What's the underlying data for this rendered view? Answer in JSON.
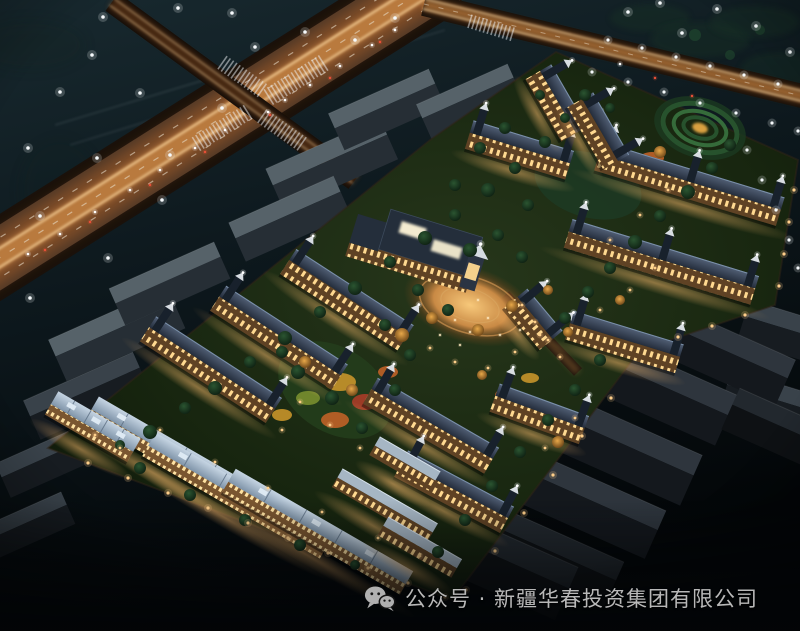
{
  "caption": {
    "text": "公众号 · 新疆华春投资集团有限公司",
    "icon": "wechat-icon"
  },
  "palette": {
    "sky_top": "#18292f",
    "sky_mid": "#0d181d",
    "sky_bottom": "#030608",
    "road_base": "#513826",
    "road_glow": "#c06a2c",
    "road_hot": "#f5a855",
    "streak": "#ffd9a0",
    "lane_dash": "#e8dcc8",
    "roof_slate_hi": "#526076",
    "roof_slate_lo": "#242d3c",
    "ridge": "#8097b1",
    "facade_dark": "#5f4224",
    "window_warm": "#ffd990",
    "roof_blue_hi": "#c6d5e3",
    "roof_blue_lo": "#7e93a8",
    "flat_roof": "#a6b6c4",
    "lawn_hi": "#27371b",
    "lawn_lo": "#0d1609",
    "tree_dark": "#152e1b",
    "tree_mid": "#2b5531",
    "tree_lit": "#c58a35",
    "wall_light": "#ffcf8a",
    "white_light": "#f6fafc",
    "red_tail": "#e85038",
    "plaza_core": "#f7c87a",
    "plaza_mid": "#9a6030",
    "caption_text": "#b8b8b8",
    "wechat_icon": "#b0b0b0"
  },
  "scene": {
    "sky_lights": [
      [
        103,
        17
      ],
      [
        178,
        8
      ],
      [
        232,
        13
      ],
      [
        305,
        32
      ],
      [
        355,
        40
      ],
      [
        395,
        18
      ],
      [
        92,
        55
      ],
      [
        255,
        47
      ],
      [
        60,
        92
      ],
      [
        140,
        93
      ],
      [
        222,
        108
      ],
      [
        28,
        148
      ],
      [
        97,
        158
      ],
      [
        170,
        155
      ],
      [
        162,
        200
      ],
      [
        40,
        216
      ],
      [
        108,
        258
      ],
      [
        30,
        298
      ],
      [
        628,
        12
      ],
      [
        682,
        33
      ],
      [
        717,
        9
      ],
      [
        756,
        26
      ],
      [
        790,
        52
      ],
      [
        660,
        3
      ]
    ],
    "road_c_lights": [
      [
        608,
        40
      ],
      [
        642,
        48
      ],
      [
        676,
        57
      ],
      [
        710,
        66
      ],
      [
        744,
        75
      ],
      [
        778,
        84
      ],
      [
        592,
        72
      ],
      [
        628,
        82
      ],
      [
        664,
        92
      ],
      [
        700,
        103
      ],
      [
        736,
        113
      ],
      [
        772,
        123
      ],
      [
        798,
        131
      ]
    ],
    "right_lights": [
      [
        747,
        150
      ],
      [
        762,
        180
      ],
      [
        776,
        210
      ],
      [
        789,
        240
      ],
      [
        798,
        268
      ]
    ],
    "wall_lights": [
      [
        88,
        463
      ],
      [
        128,
        478
      ],
      [
        168,
        493
      ],
      [
        208,
        508
      ],
      [
        248,
        523
      ],
      [
        288,
        538
      ],
      [
        328,
        553
      ],
      [
        368,
        568
      ],
      [
        408,
        583
      ],
      [
        445,
        597
      ],
      [
        794,
        190
      ],
      [
        789,
        222
      ],
      [
        784,
        254
      ],
      [
        779,
        286
      ],
      [
        745,
        315
      ],
      [
        712,
        326
      ],
      [
        678,
        337
      ],
      [
        611,
        398
      ],
      [
        582,
        436
      ],
      [
        553,
        475
      ],
      [
        524,
        513
      ],
      [
        495,
        551
      ],
      [
        466,
        590
      ]
    ],
    "path_lamps": [
      [
        160,
        430
      ],
      [
        215,
        462
      ],
      [
        268,
        488
      ],
      [
        322,
        512
      ],
      [
        378,
        538
      ],
      [
        420,
        556
      ],
      [
        300,
        402
      ],
      [
        330,
        425
      ],
      [
        360,
        448
      ],
      [
        282,
        430
      ],
      [
        430,
        348
      ],
      [
        455,
        362
      ],
      [
        488,
        368
      ],
      [
        515,
        352
      ],
      [
        540,
        335
      ],
      [
        522,
        305
      ],
      [
        535,
        322
      ],
      [
        548,
        340
      ],
      [
        560,
        357
      ],
      [
        600,
        310
      ],
      [
        630,
        290
      ],
      [
        655,
        268
      ],
      [
        120,
        448
      ],
      [
        95,
        435
      ],
      [
        575,
        418
      ],
      [
        545,
        448
      ],
      [
        610,
        240
      ],
      [
        640,
        215
      ],
      [
        668,
        190
      ]
    ],
    "car_white": [
      [
        395,
        30
      ],
      [
        372,
        45
      ],
      [
        340,
        66
      ],
      [
        310,
        85
      ],
      [
        285,
        100
      ],
      [
        225,
        130
      ],
      [
        195,
        148
      ],
      [
        160,
        170
      ],
      [
        130,
        190
      ],
      [
        95,
        212
      ],
      [
        60,
        234
      ],
      [
        28,
        254
      ],
      [
        620,
        64
      ],
      [
        268,
        112
      ]
    ],
    "car_red": [
      [
        380,
        42
      ],
      [
        330,
        78
      ],
      [
        270,
        115
      ],
      [
        205,
        152
      ],
      [
        150,
        185
      ],
      [
        90,
        222
      ],
      [
        45,
        250
      ],
      [
        655,
        78
      ],
      [
        692,
        96
      ]
    ],
    "people": [
      [
        455,
        320
      ],
      [
        470,
        332
      ],
      [
        488,
        318
      ],
      [
        500,
        335
      ],
      [
        460,
        345
      ],
      [
        520,
        330
      ],
      [
        478,
        300
      ],
      [
        440,
        335
      ]
    ],
    "buildings": [
      {
        "cx": 690,
        "cy": 182,
        "len": 190,
        "rot": 17,
        "style": "A"
      },
      {
        "cx": 662,
        "cy": 260,
        "len": 195,
        "rot": 17,
        "style": "A"
      },
      {
        "cx": 625,
        "cy": 340,
        "len": 115,
        "rot": 17,
        "style": "A"
      },
      {
        "cx": 540,
        "cy": 412,
        "len": 95,
        "rot": 20,
        "style": "A"
      },
      {
        "cx": 520,
        "cy": 148,
        "len": 105,
        "rot": 17,
        "style": "A"
      },
      {
        "cx": 558,
        "cy": 102,
        "len": 72,
        "rot": 60,
        "style": "A"
      },
      {
        "cx": 600,
        "cy": 130,
        "len": 72,
        "rot": 60,
        "style": "A"
      },
      {
        "cx": 212,
        "cy": 368,
        "len": 150,
        "rot": 33,
        "style": "A"
      },
      {
        "cx": 280,
        "cy": 336,
        "len": 145,
        "rot": 33,
        "style": "A"
      },
      {
        "cx": 348,
        "cy": 298,
        "len": 140,
        "rot": 33,
        "style": "A"
      },
      {
        "cx": 432,
        "cy": 424,
        "len": 140,
        "rot": 30,
        "style": "A"
      },
      {
        "cx": 455,
        "cy": 490,
        "len": 120,
        "rot": 28,
        "style": "A"
      },
      {
        "cx": 535,
        "cy": 318,
        "len": 55,
        "rot": 50,
        "style": "A"
      },
      {
        "cx": 165,
        "cy": 452,
        "len": 170,
        "rot": 30,
        "style": "B"
      },
      {
        "cx": 237,
        "cy": 497,
        "len": 205,
        "rot": 30,
        "style": "B"
      },
      {
        "cx": 317,
        "cy": 533,
        "len": 205,
        "rot": 30,
        "style": "B"
      },
      {
        "cx": 92,
        "cy": 428,
        "len": 95,
        "rot": 30,
        "style": "B"
      },
      {
        "cx": 385,
        "cy": 505,
        "len": 110,
        "rot": 30,
        "style": "C"
      },
      {
        "cx": 420,
        "cy": 547,
        "len": 85,
        "rot": 30,
        "style": "C"
      },
      {
        "cx": 405,
        "cy": 463,
        "len": 70,
        "rot": 30,
        "style": "C"
      }
    ],
    "gray_blocks": [
      [
        330,
        160,
        125,
        36,
        -24,
        "a"
      ],
      [
        288,
        215,
        115,
        34,
        -24,
        "a"
      ],
      [
        385,
        106,
        110,
        32,
        -24,
        "a"
      ],
      [
        468,
        98,
        100,
        30,
        -24,
        "a"
      ],
      [
        115,
        330,
        130,
        36,
        -24,
        "a"
      ],
      [
        85,
        392,
        120,
        34,
        -24,
        "b"
      ],
      [
        168,
        280,
        115,
        32,
        -24,
        "a"
      ],
      [
        45,
        458,
        95,
        30,
        -24,
        "b"
      ],
      [
        28,
        522,
        85,
        28,
        -24,
        "b"
      ],
      [
        790,
        330,
        95,
        34,
        17,
        "b"
      ],
      [
        770,
        398,
        90,
        32,
        17,
        "b"
      ],
      [
        660,
        385,
        150,
        44,
        24,
        "p"
      ],
      [
        625,
        445,
        150,
        44,
        24,
        "p"
      ],
      [
        590,
        500,
        148,
        42,
        24,
        "p"
      ],
      [
        552,
        552,
        140,
        40,
        24,
        "q"
      ],
      [
        735,
        355,
        115,
        40,
        24,
        "p"
      ],
      [
        778,
        425,
        100,
        36,
        24,
        "q"
      ],
      [
        505,
        560,
        140,
        46,
        24,
        "q"
      ]
    ],
    "trees": [
      [
        150,
        432,
        7
      ],
      [
        185,
        408,
        6
      ],
      [
        215,
        388,
        7
      ],
      [
        250,
        362,
        6
      ],
      [
        285,
        338,
        7
      ],
      [
        320,
        312,
        6
      ],
      [
        355,
        288,
        7
      ],
      [
        390,
        262,
        6
      ],
      [
        425,
        238,
        7
      ],
      [
        455,
        215,
        6
      ],
      [
        488,
        190,
        7
      ],
      [
        515,
        168,
        6
      ],
      [
        545,
        142,
        6
      ],
      [
        565,
        118,
        5
      ],
      [
        585,
        95,
        6
      ],
      [
        610,
        108,
        5
      ],
      [
        540,
        95,
        5
      ],
      [
        505,
        128,
        6
      ],
      [
        480,
        148,
        6
      ],
      [
        730,
        145,
        6
      ],
      [
        712,
        168,
        6
      ],
      [
        688,
        192,
        7
      ],
      [
        660,
        216,
        6
      ],
      [
        635,
        242,
        7
      ],
      [
        610,
        268,
        6
      ],
      [
        588,
        292,
        6
      ],
      [
        565,
        318,
        6
      ],
      [
        600,
        360,
        6
      ],
      [
        575,
        390,
        6
      ],
      [
        548,
        420,
        6
      ],
      [
        520,
        452,
        6
      ],
      [
        492,
        486,
        6
      ],
      [
        465,
        520,
        6
      ],
      [
        438,
        552,
        6
      ],
      [
        140,
        468,
        6
      ],
      [
        190,
        495,
        6
      ],
      [
        245,
        520,
        6
      ],
      [
        300,
        545,
        6
      ],
      [
        355,
        565,
        5
      ],
      [
        120,
        445,
        5
      ],
      [
        470,
        250,
        7
      ],
      [
        498,
        235,
        6
      ],
      [
        522,
        257,
        6
      ],
      [
        455,
        185,
        6
      ],
      [
        528,
        205,
        6
      ],
      [
        410,
        355,
        6
      ],
      [
        385,
        325,
        6
      ],
      [
        298,
        372,
        7
      ],
      [
        332,
        398,
        7
      ],
      [
        362,
        428,
        6
      ],
      [
        395,
        390,
        6
      ],
      [
        282,
        352,
        6
      ],
      [
        448,
        310,
        6
      ],
      [
        418,
        290,
        6
      ]
    ],
    "lit_trees": [
      [
        402,
        335,
        7
      ],
      [
        432,
        318,
        6
      ],
      [
        478,
        330,
        6
      ],
      [
        512,
        306,
        6
      ],
      [
        548,
        290,
        5
      ],
      [
        660,
        152,
        6
      ],
      [
        305,
        362,
        6
      ],
      [
        352,
        390,
        6
      ],
      [
        558,
        442,
        6
      ],
      [
        482,
        375,
        5
      ],
      [
        568,
        332,
        5
      ],
      [
        620,
        300,
        5
      ]
    ],
    "flower_colors": [
      "#c96428",
      "#d19a2c",
      "#b23c28",
      "#7e9430"
    ],
    "flower_patches": [
      [
        315,
        360,
        14,
        8,
        0
      ],
      [
        340,
        382,
        16,
        9,
        1
      ],
      [
        365,
        402,
        13,
        8,
        2
      ],
      [
        308,
        398,
        12,
        7,
        3
      ],
      [
        388,
        372,
        10,
        6,
        0
      ],
      [
        335,
        420,
        14,
        8,
        0
      ],
      [
        282,
        415,
        10,
        6,
        1
      ],
      [
        652,
        158,
        12,
        6,
        0
      ],
      [
        625,
        172,
        10,
        5,
        3
      ],
      [
        505,
        395,
        10,
        6,
        0
      ],
      [
        530,
        378,
        9,
        5,
        1
      ]
    ],
    "crosswalks": [
      [
        296,
        80,
        64,
        18,
        -32
      ],
      [
        222,
        128,
        60,
        16,
        -32
      ],
      [
        243,
        77,
        50,
        16,
        35
      ],
      [
        282,
        130,
        48,
        16,
        35
      ],
      [
        492,
        28,
        46,
        14,
        17
      ]
    ]
  }
}
